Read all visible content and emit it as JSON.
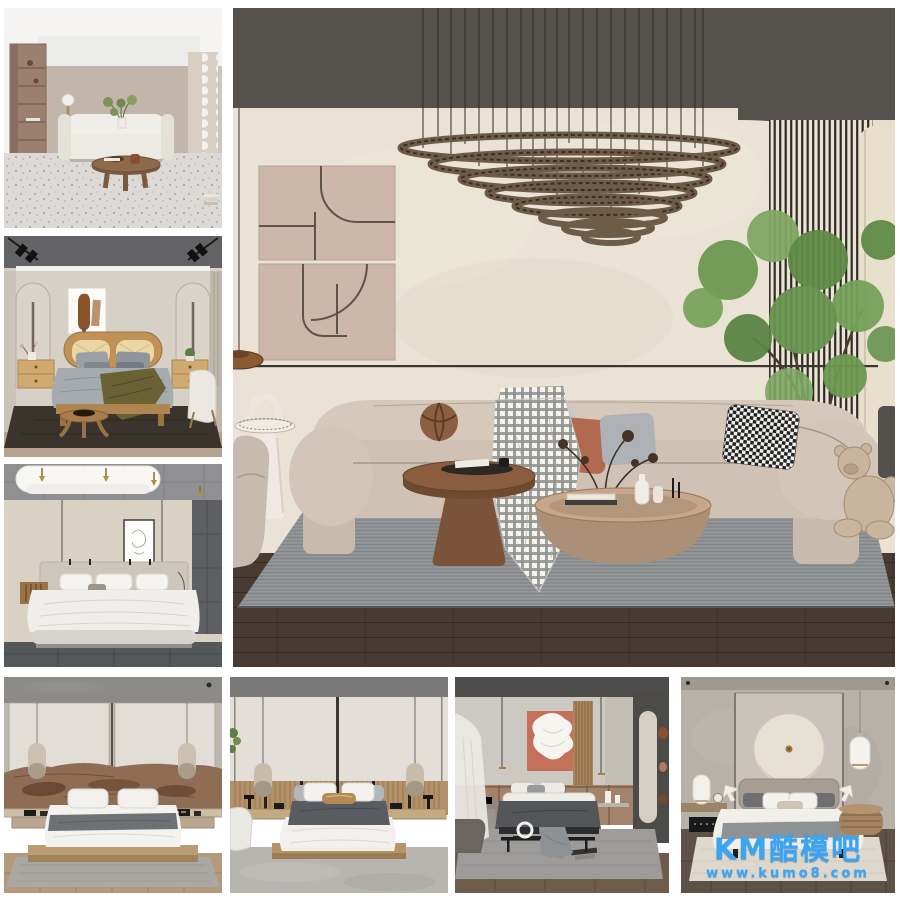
{
  "canvas": {
    "width": 900,
    "height": 900,
    "background": "#ffffff"
  },
  "watermark": {
    "brand": "KM酷模吧",
    "url": "www.kumo8.com",
    "color": "#38a6f4"
  },
  "gallery": {
    "layout": "collage",
    "tiles": [
      {
        "name": "thumb-living-room-cream-sofa",
        "position": "left-top"
      },
      {
        "name": "thumb-bedroom-wood-bed",
        "position": "left-middle"
      },
      {
        "name": "thumb-bedroom-canopy-bed",
        "position": "left-bottom"
      },
      {
        "name": "preview-living-room-curved-sofa",
        "position": "center-main"
      },
      {
        "name": "thumb-bedroom-live-edge-headboard",
        "position": "bottom-1"
      },
      {
        "name": "thumb-bedroom-slat-wainscot",
        "position": "bottom-2"
      },
      {
        "name": "thumb-bedroom-terracotta-art",
        "position": "bottom-3"
      },
      {
        "name": "thumb-bedroom-circle-art",
        "position": "bottom-4"
      }
    ]
  },
  "palette": {
    "ceiling_dark": "#55524e",
    "wall_cream": "#e9e2d5",
    "sofa_beige": "#cfc1b4",
    "terracotta": "#b26a50",
    "wood_brown": "#8a6a52",
    "rug_gray": "#8e9092",
    "floor_dark": "#483c32",
    "plant_green": "#6f9a55"
  }
}
